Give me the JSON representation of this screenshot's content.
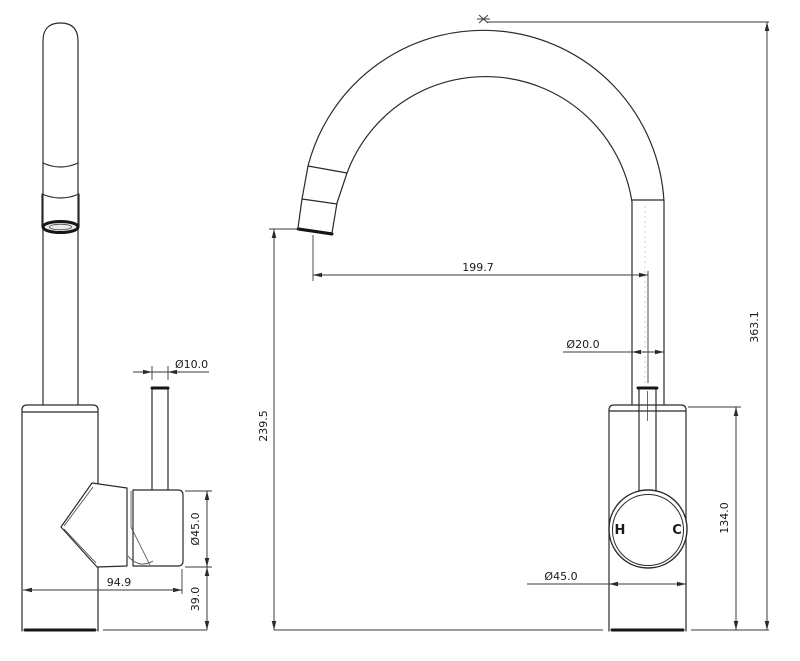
{
  "drawing": {
    "background": "#ffffff",
    "line_color": "#2b2b2b",
    "views": [
      "side view",
      "front view"
    ]
  },
  "handle_labels": {
    "hot": "H",
    "cold": "C"
  },
  "dimensions": {
    "side_view": {
      "hose_diameter": "Ø10.0",
      "handle_diameter": "Ø45.0",
      "body_depth": "94.9",
      "base_section_height": "39.0"
    },
    "front_view": {
      "spout_reach": "199.7",
      "spout_clearance_height": "239.5",
      "riser_diameter": "Ø20.0",
      "overall_height": "363.1",
      "body_height": "134.0",
      "body_diameter": "Ø45.0"
    }
  }
}
